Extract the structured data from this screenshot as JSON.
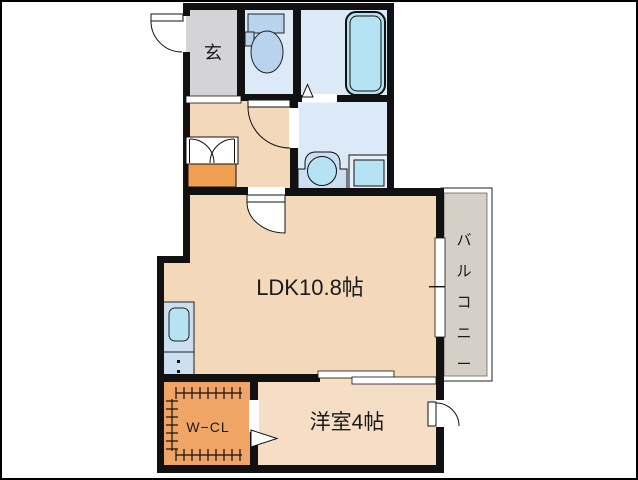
{
  "plan_title": "apartment-floor-plan",
  "rooms": {
    "genkan": {
      "label": "玄"
    },
    "ldk": {
      "label": "LDK10.8帖"
    },
    "western_room": {
      "label": "洋室4帖"
    },
    "walk_in_closet": {
      "label": "W−CL"
    },
    "balcony": {
      "label": "バルコニー",
      "chars": [
        "バ",
        "ル",
        "コ",
        "ニ",
        "ー"
      ]
    }
  },
  "fixtures": [
    "toilet-icon",
    "bathtub-icon",
    "washbasin-icon",
    "washing-machine-pan-icon",
    "kitchen-sink-icon",
    "door-swing-icon",
    "sliding-door-icon",
    "closet-double-door-icon"
  ],
  "colors": {
    "wall": "#111111",
    "peach": "#f4d8ba",
    "peach_light": "#f5ddc6",
    "genkan_gray": "#d4d4d8",
    "wet_room_blue": "#dce9f7",
    "fixture_blue": "#b9d3ee",
    "cyan": "#b5e3f4",
    "counter_blue": "#ccdff2",
    "closet_orange": "#f0a466",
    "shelf_orange": "#f0a050",
    "balcony_gray": "#d6cfc7"
  }
}
